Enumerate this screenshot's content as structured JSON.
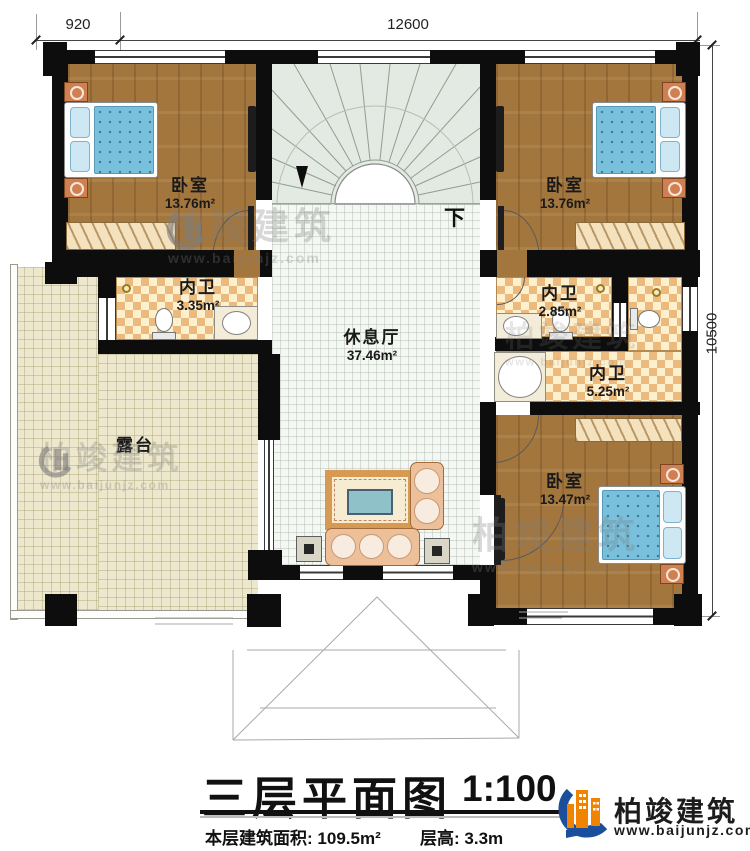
{
  "dimensions": {
    "left_offset": "920",
    "top_width": "12600",
    "right_height": "10500"
  },
  "plan": {
    "stairs": {
      "down_label": "下"
    },
    "rooms": [
      {
        "name": "卧室",
        "area": "13.76m²"
      },
      {
        "name": "卧室",
        "area": "13.76m²"
      },
      {
        "name": "内卫",
        "area": "3.35m²"
      },
      {
        "name": "内卫",
        "area": "2.85m²"
      },
      {
        "name": "内卫",
        "area": "5.25m²"
      },
      {
        "name": "休息厅",
        "area": "37.46m²"
      },
      {
        "name": "露台",
        "area": ""
      },
      {
        "name": "卧室",
        "area": "13.47m²"
      }
    ]
  },
  "watermark": {
    "brand": "柏竣建筑",
    "url": "www.baijunjz.com"
  },
  "title_block": {
    "title": "三层平面图",
    "scale": "1:100",
    "area_label": "本层建筑面积:",
    "area_value": "109.5m²",
    "floor_height_label": "层高:",
    "floor_height_value": "3.3m"
  },
  "logo": {
    "brand": "柏竣建筑",
    "url": "www.baijunjz.com"
  }
}
